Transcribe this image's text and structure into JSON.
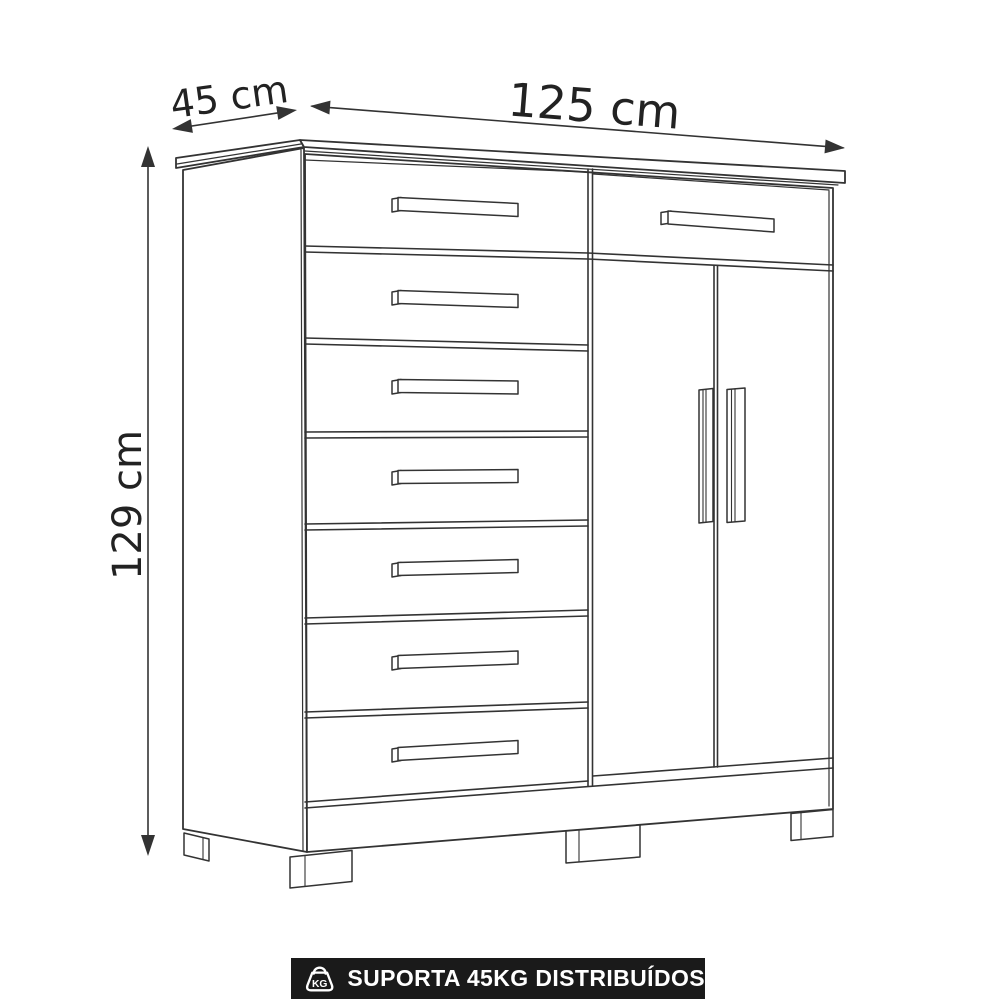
{
  "dimension_labels": {
    "depth": "45 cm",
    "width": "125 cm",
    "height": "129 cm"
  },
  "cabinet": {
    "left_drawer_count": 7,
    "right_drawer_count": 1,
    "door_count": 2,
    "visible_leg_count": 4
  },
  "badge": {
    "label": "SUPORTA 45KG DISTRIBUÍDOS",
    "icon_text": "KG",
    "background_color": "#1a1a1a",
    "text_color": "#ffffff"
  },
  "style": {
    "line_color": "#333333",
    "background_color": "#ffffff"
  }
}
